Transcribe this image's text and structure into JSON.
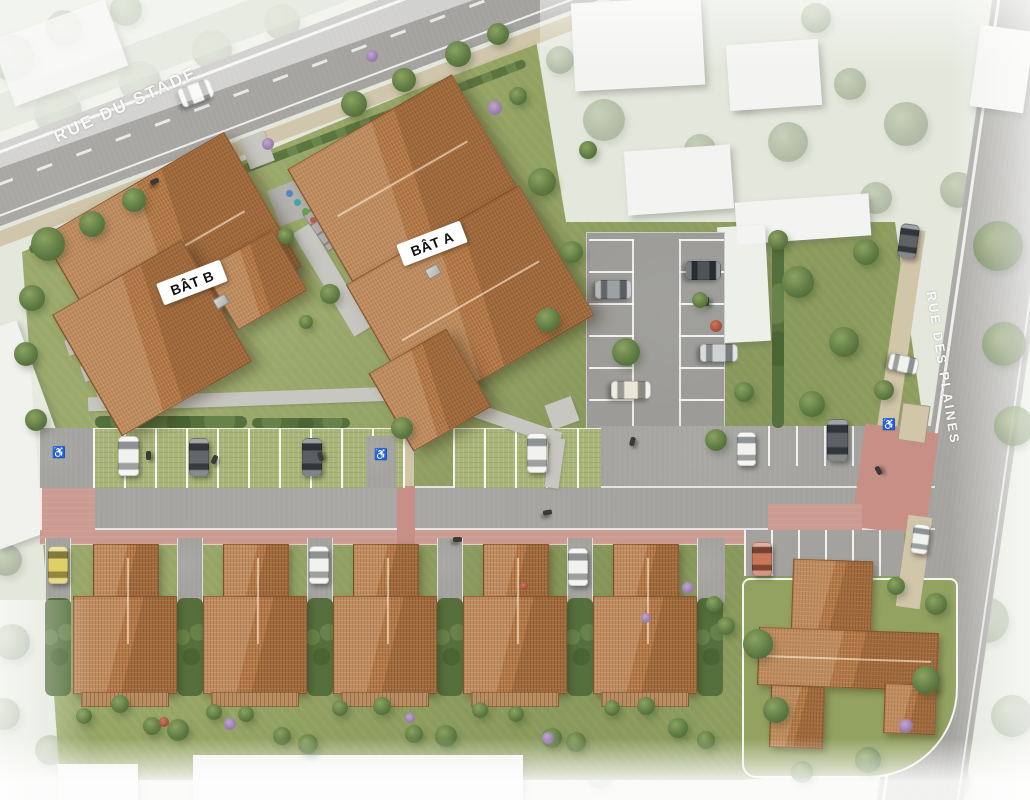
{
  "meta": {
    "type": "residential development aerial site plan",
    "view": "top-down rendering"
  },
  "streets": [
    {
      "name": "RUE DU STADE"
    },
    {
      "name": "RUE DES PLAINES"
    }
  ],
  "buildings": [
    {
      "label": "BÂT A"
    },
    {
      "label": "BÂT B"
    }
  ],
  "symbols": {
    "accessible_parking": "♿"
  },
  "colors": {
    "roof_tile": "#b47a49",
    "lawn": "#95a463",
    "grass_paver_parking": "#a9b478",
    "asphalt": "#a3a29e",
    "pedestrian_path_pink": "#cb9a91",
    "sidewalk_beige": "#d2c6aa",
    "context_building_white": "#f3f4f1",
    "tree_canopy": "#5e7a43",
    "road_marking_white": "#ffffff",
    "label_text": "#111111"
  }
}
